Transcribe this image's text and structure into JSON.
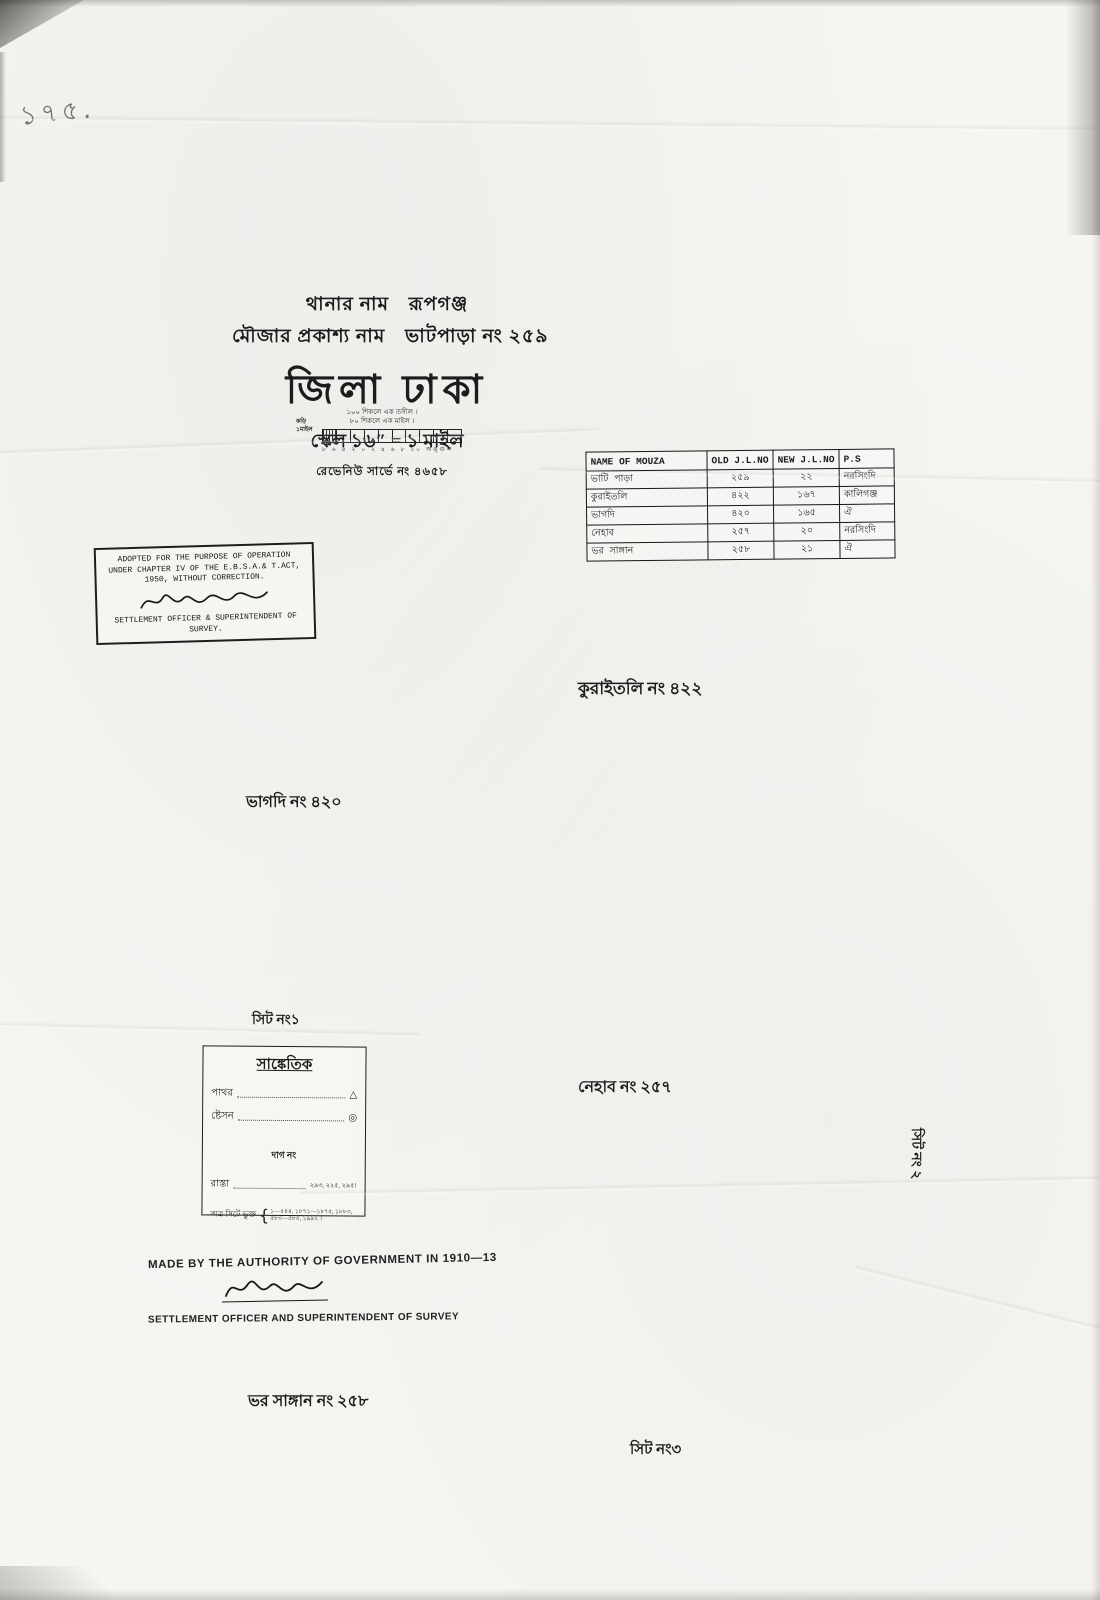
{
  "page": {
    "corner_note": "১৭৫.",
    "paper_color": "#f6f5f2",
    "ink_color": "#1c1c1c",
    "pencil_color": "#75746f"
  },
  "header": {
    "thana_label": "থানার নাম",
    "thana_value": "রূপগঞ্জ",
    "mouza_label": "মৌজার প্রকাশ্য নাম",
    "mouza_value": "ভাটপাড়া নং ২৫৯",
    "district_title": "জিলা ঢাকা",
    "scale_line": "স্কেল ১৬″ = ১ মাইল"
  },
  "scale_bar": {
    "note1": "১০০ শিকলে এক তসীল ।",
    "note2": "৮০ শিকলে এক মাইল ।",
    "left_label1": "কড়ি",
    "left_label2": "১মাইল",
    "tick_labels": "৮ ৬ ৪ ২ ০ ২ ৪ ৬ ৮ ১০ অঙ্গুল",
    "revenue_line": "রেভেনিউ সার্ভে নং ৪৬৫৮"
  },
  "mouza_table": {
    "headers": [
      "NAME OF MOUZA",
      "OLD J.L.NO",
      "NEW J.L.NO",
      "P.S"
    ],
    "rows": [
      [
        "ভাটি পাড়া",
        "২৫৯",
        "২২",
        "নরসিংদি"
      ],
      [
        "কুরাইতলি",
        "৪২২",
        "১৬৭",
        "কালিগঞ্জ"
      ],
      [
        "ভাগদি",
        "৪২০",
        "১৬৫",
        "ঐ"
      ],
      [
        "নেহাব",
        "২৫৭",
        "২০",
        "নরসিংদি"
      ],
      [
        "ভর সাঙ্গান",
        "২৫৮",
        "২১",
        "ঐ"
      ]
    ]
  },
  "stamp": {
    "line1": "ADOPTED FOR THE PURPOSE OF OPERATION",
    "line2": "UNDER CHAPTER IV OF THE E.B.S.A.& T.ACT,",
    "line3": "1950, WITHOUT CORRECTION.",
    "line4": "SETTLEMENT OFFICER & SUPERINTENDENT OF",
    "line5": "SURVEY."
  },
  "map_labels": {
    "north_neighbor": "কুরাইতলি নং ৪২২",
    "west_neighbor": "ভাগদি নং ৪২০",
    "sheet1": "সিট নং১",
    "center_neighbor": "নেহাব নং ২৫৭",
    "sheet2": "সিট নং ২",
    "southwest_neighbor": "ভর সাঙ্গান নং ২৫৮",
    "sheet3": "সিট নং৩"
  },
  "legend": {
    "title": "সাঙ্কেতিক",
    "items": [
      {
        "label": "পাথর",
        "icon": "boundary-stone-triangle-icon",
        "glyph": "△"
      },
      {
        "label": "ষ্টেসন",
        "icon": "survey-station-circle-icon",
        "glyph": "◎"
      }
    ],
    "dag_heading": "দাগ নং",
    "road_label": "রাস্তা",
    "road_numbers": "২৯৩, ২২৫, ২৯৫।",
    "included_label": "অত্র সিটে ভুক্ত",
    "included_brace": "{",
    "included_numbers_line1": "১—৫৪৪, ১৮৭১—১৮৭৫, ১৮৮৩,",
    "included_numbers_line2": "৫৮৩—৫৮৫, ১৯৯২ ।"
  },
  "footer": {
    "authority_line": "MADE BY THE AUTHORITY OF GOVERNMENT IN 1910—13",
    "officer_line": "SETTLEMENT OFFICER AND SUPERINTENDENT OF SURVEY"
  },
  "glyphs": {
    "bengali_digits": "০১২৩৪৫৬৭৮৯"
  }
}
